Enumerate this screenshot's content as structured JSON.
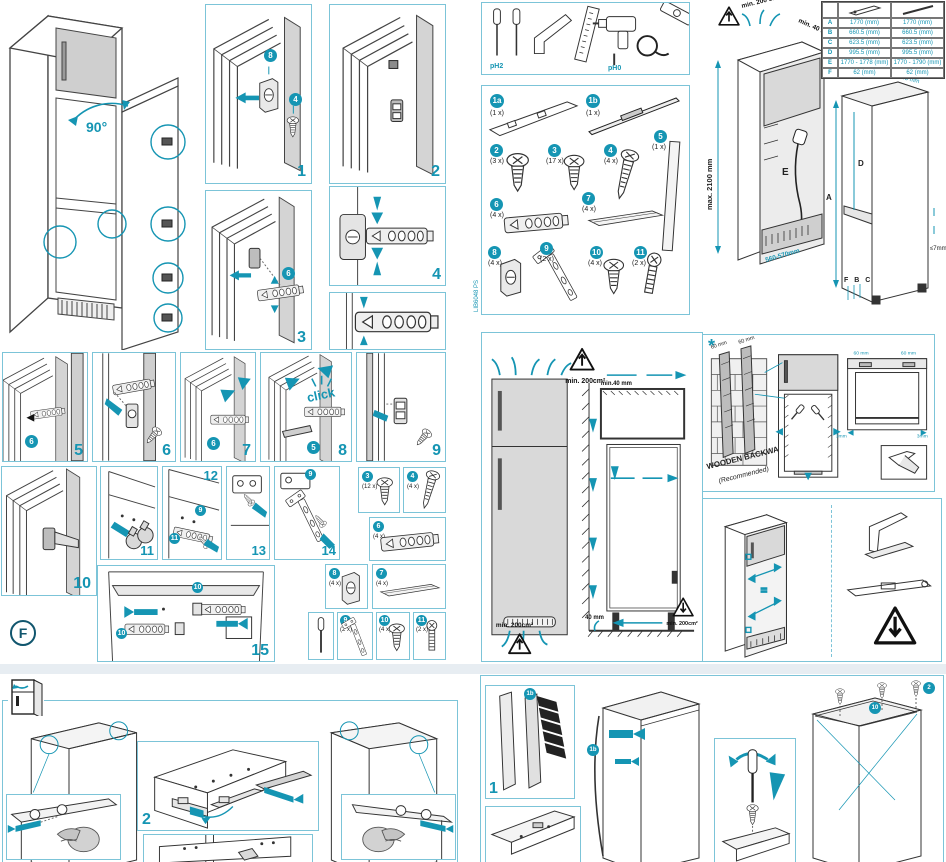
{
  "doc_code": "LIB6048 PS",
  "colors": {
    "accent": "#1595b3",
    "panel_border": "#7cc4d8",
    "fill_gray": "#d9d9d9"
  },
  "overview": {
    "angle": "90°"
  },
  "steps": {
    "s1": "1",
    "s2": "2",
    "s3": "3",
    "s4": "4",
    "s5": "5",
    "s6": "6",
    "s7": "7",
    "s8": "8",
    "s9": "9",
    "s10": "10",
    "s11": "11",
    "s12": "12",
    "s13": "13",
    "s14": "14",
    "s15": "15",
    "click": "click"
  },
  "refs": {
    "r8": "8",
    "r4": "4",
    "r6": "6",
    "r5": "5",
    "r9": "9",
    "r11": "11",
    "r10": "10",
    "r2": "2",
    "r1b": "1b"
  },
  "section_label": "F",
  "tools": {
    "ph2": "pH2",
    "ph0": "pH0"
  },
  "parts": [
    {
      "id": "1a",
      "qty": "(1 x)"
    },
    {
      "id": "1b",
      "qty": "(1 x)"
    },
    {
      "id": "2",
      "qty": "(3 x)"
    },
    {
      "id": "3",
      "qty": "(17 x)"
    },
    {
      "id": "4",
      "qty": "(4 x)"
    },
    {
      "id": "5",
      "qty": "(1 x)"
    },
    {
      "id": "6",
      "qty": "(4 x)"
    },
    {
      "id": "7",
      "qty": "(4 x)"
    },
    {
      "id": "8",
      "qty": "(4 x)"
    },
    {
      "id": "9",
      "qty": "(2 x)"
    },
    {
      "id": "10",
      "qty": "(4 x)"
    },
    {
      "id": "11",
      "qty": "(2 x)"
    }
  ],
  "side_parts": [
    {
      "id": "3",
      "qty": "(12 x)"
    },
    {
      "id": "4",
      "qty": "(4 x)"
    },
    {
      "id": "6",
      "qty": "(4 x)"
    },
    {
      "id": "8",
      "qty": "(4 x)"
    },
    {
      "id": "7",
      "qty": "(4 x)"
    },
    {
      "id": "9",
      "qty": "(2 x)"
    },
    {
      "id": "10",
      "qty": "(4 x)"
    },
    {
      "id": "11",
      "qty": "(2 x)"
    }
  ],
  "dim_table": {
    "rows": [
      {
        "k": "A",
        "v1": "1770 (mm)",
        "v2": "1770 (mm)"
      },
      {
        "k": "B",
        "v1": "660.5 (mm)",
        "v2": "660.5 (mm)"
      },
      {
        "k": "C",
        "v1": "623.5 (mm)",
        "v2": "623.5 (mm)"
      },
      {
        "k": "D",
        "v1": "995.5 (mm)",
        "v2": "995.5 (mm)"
      },
      {
        "k": "E",
        "v1": "1770 - 1778 (mm)",
        "v2": "1770 - 1790 (mm)"
      },
      {
        "k": "F",
        "v1": "62 (mm)",
        "v2": "62 (mm)"
      }
    ]
  },
  "niche": {
    "vent": "min. 200 cm²",
    "gap": "min. 40 mm",
    "height": "max. 2100 mm",
    "depth": "560-570mm",
    "w1": "540 mm",
    "w2": "545 mm",
    "la": "A",
    "ld": "D",
    "le": "E",
    "lfbc": "F B C",
    "tol": "≤7mm"
  },
  "vent": {
    "area_top": "min. 200cm²",
    "gap_top": "min.40 mm",
    "gap_bottom": "40 mm",
    "area_bottom": "min. 200cm²",
    "area_right": "min. 200cm²"
  },
  "backwall": {
    "star": "*",
    "g1": "60 mm",
    "g2": "60 mm",
    "title": "WOODEN BACKWALL",
    "sub": "(Recommended)",
    "t1": "60 mm",
    "t2": "60 mm",
    "m1": "3mm",
    "m2": "3mm"
  },
  "bottom_left": {
    "step": "2"
  },
  "bottom_right": {
    "step": "1"
  }
}
